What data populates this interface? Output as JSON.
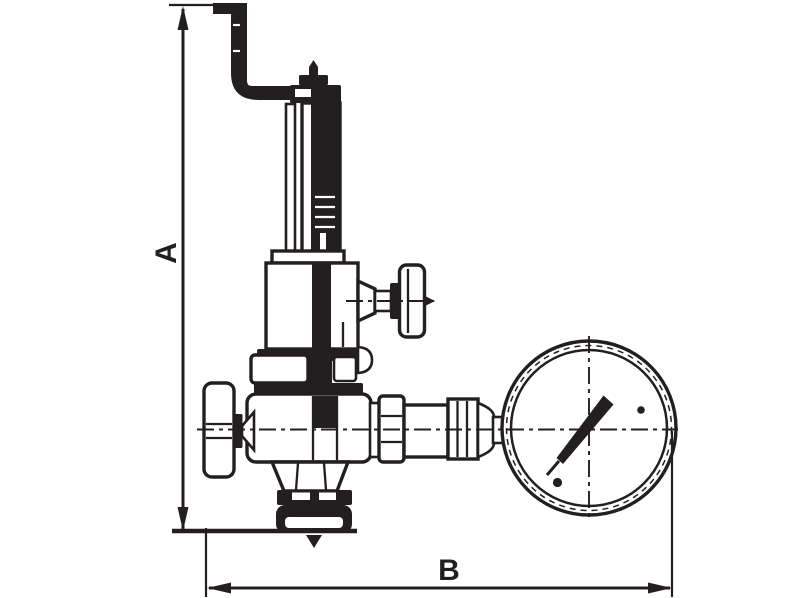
{
  "drawing": {
    "type": "technical dimension drawing",
    "subject": "safety relief / pressure reducing valve with relief pipe, side handle, inlet handwheel and pressure gauge",
    "dimensions": {
      "vertical": {
        "label": "A"
      },
      "horizontal": {
        "label": "B"
      }
    },
    "colors": {
      "line": "#231f20",
      "background": "#ffffff"
    }
  }
}
